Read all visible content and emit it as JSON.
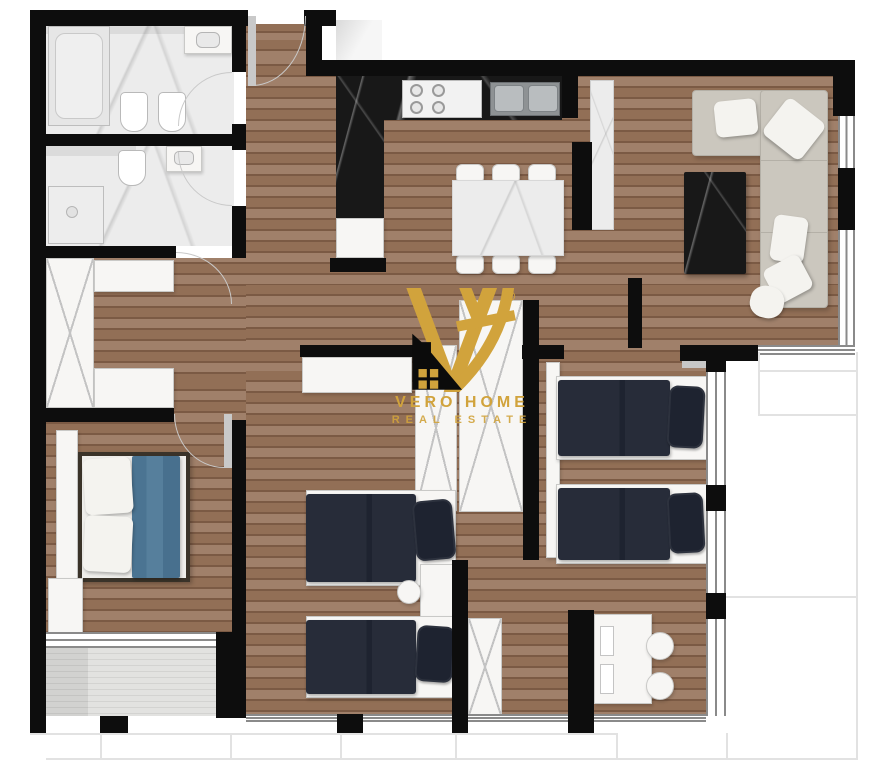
{
  "watermark": {
    "monogram": "VH",
    "registered": "®",
    "brand": "VERO HOME",
    "tagline": "REAL ESTATE",
    "logo_icon": "house-icon"
  },
  "colors": {
    "wall": "#0d0d0d",
    "wood-a": "#926f56",
    "wood-b": "#7b5a44",
    "wood-c": "#a0806a",
    "marble-light": "#ececec",
    "counter-dark": "#181818",
    "sofa": "#cbc7be",
    "sofa-line": "#b4b0a7",
    "cushion": "#f4f3ef",
    "coffee-table": "#201c1a",
    "bed-blue": "#4e7795",
    "bed-dark": "#272c39",
    "bed-dark-deep": "#1e2330",
    "furniture-white": "#f7f6f4",
    "furniture-border": "#c9c9c7",
    "deck": "#dddddc",
    "outline": "#e2e2e2",
    "gold": "#d1a33c",
    "logo-black": "#0b0b0b",
    "window-line": "#8a8a8a"
  }
}
